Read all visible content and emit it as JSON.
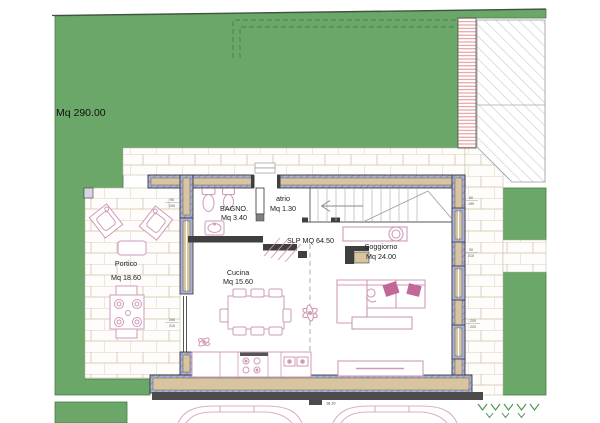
{
  "site": {
    "garden_area_label": "Mq 290.00",
    "overall_width_label": "18.10"
  },
  "rooms": {
    "bagno": {
      "name": "BAGNO.",
      "area": "Mq 3.40"
    },
    "atrio": {
      "name": "atrio",
      "area": "Mq 1.30"
    },
    "cucina": {
      "name": "Cucina",
      "area": "Mq 15.60"
    },
    "soggiorno": {
      "name": "Soggiorno",
      "area": "Mq 24.00"
    },
    "portico": {
      "name": "Portico",
      "area": "Mq 18.60"
    },
    "slp_label": "SLP MQ 64.50"
  },
  "openings": [
    {
      "w": "90",
      "h": "190"
    },
    {
      "w": "200",
      "h": "210"
    },
    {
      "w": "80",
      "h": "190"
    },
    {
      "w": "90",
      "h": "210"
    },
    {
      "w": "200",
      "h": "220"
    }
  ],
  "colors": {
    "grass": "#6aa768",
    "wall_fill": "#d8c5a0",
    "wall_insulation": "#abb1d8",
    "furniture_outline": "#cf9ab8",
    "cushion_pink": "#c2679a",
    "section_dark": "#4b4b4b",
    "roof_hatch": "#cdcdcd",
    "strip_hatch": "#e29090"
  }
}
